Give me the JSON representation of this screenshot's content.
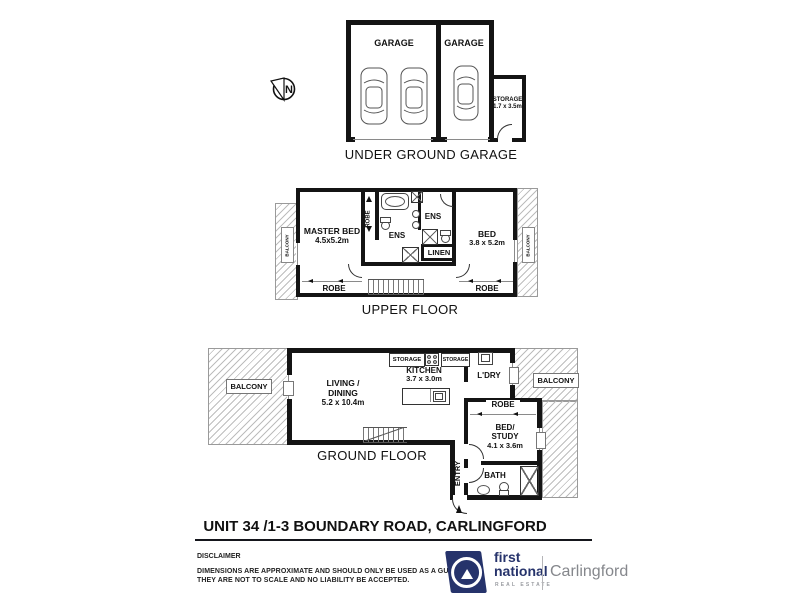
{
  "colors": {
    "ink": "#111111",
    "wall": "#141414",
    "hatch": "#bdbdbd",
    "brand_navy": "#26336b",
    "brand_gray": "#85878c"
  },
  "compass": {
    "north": "N"
  },
  "garage": {
    "title": "UNDER GROUND GARAGE",
    "garage_left": "GARAGE",
    "garage_right": "GARAGE",
    "storage": "STORAGE",
    "storage_dim": "1.7 x 3.5m"
  },
  "upper": {
    "title": "UPPER FLOOR",
    "balcony_left": "BALCONY",
    "balcony_right": "BALCONY",
    "master_bed": "MASTER BED",
    "master_bed_dim": "4.5x5.2m",
    "robe_master": "ROBE",
    "ens_master": "ENS",
    "ens_second": "ENS",
    "bed": "BED",
    "bed_dim": "3.8 x 5.2m",
    "linen": "LINEN",
    "robe_bottom_left": "ROBE",
    "robe_bottom_right": "ROBE"
  },
  "ground": {
    "title": "GROUND FLOOR",
    "balcony_left": "BALCONY",
    "balcony_right": "BALCONY",
    "living_line1": "LIVING /",
    "living_line2": "DINING",
    "living_dim": "5.2 x 10.4m",
    "kitchen": "KITCHEN",
    "kitchen_dim": "3.7 x 3.0m",
    "storage_left": "STORAGE",
    "storage_right": "STORAGE",
    "laundry": "L'DRY",
    "robe": "ROBE",
    "bed_study_line1": "BED/",
    "bed_study_line2": "STUDY",
    "bed_study_dim": "4.1 x 3.6m",
    "entry": "ENTRY",
    "bath": "BATH"
  },
  "footer": {
    "address": "UNIT 34 /1-3 BOUNDARY ROAD, CARLINGFORD",
    "disclaimer_title": "DISCLAIMER",
    "disclaimer_line1": "DIMENSIONS ARE APPROXIMATE AND SHOULD ONLY BE USED AS A GUIDE",
    "disclaimer_line2": "THEY ARE NOT TO SCALE AND NO LIABILITY BE ACCEPTED."
  },
  "brand": {
    "line1": "first",
    "line2": "national",
    "tagline": "REAL ESTATE",
    "office": "Carlingford"
  }
}
